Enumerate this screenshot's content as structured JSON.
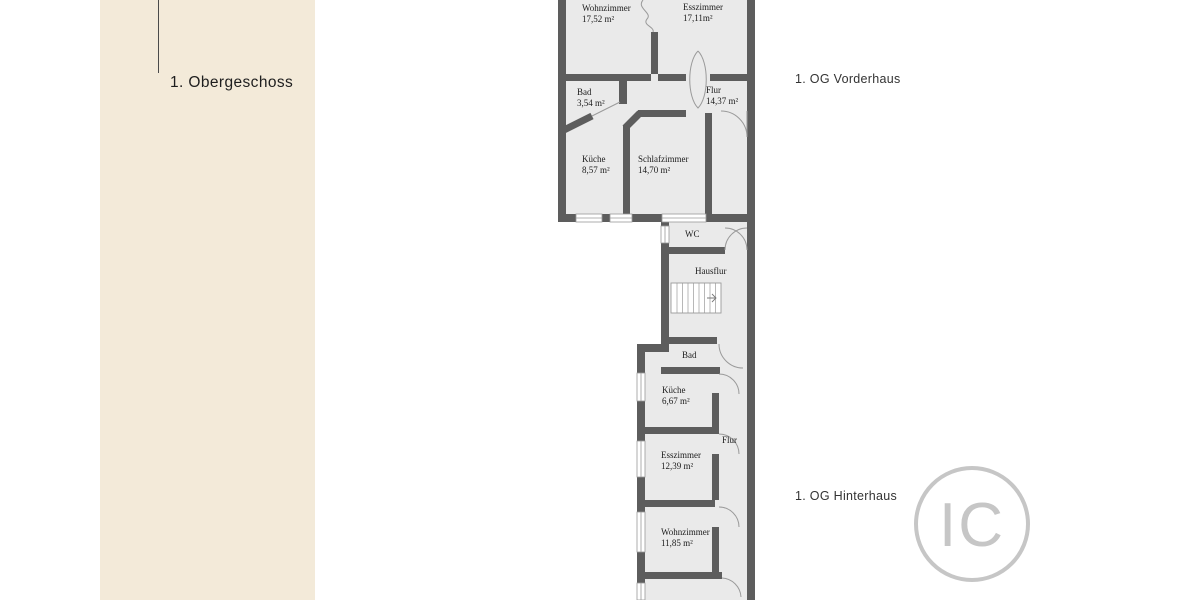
{
  "page": {
    "background": "#ffffff"
  },
  "sidebar": {
    "background_color": "#f3ead9",
    "title": "1. Obergeschoss"
  },
  "plan": {
    "wall_color": "#5d5d5d",
    "floor_color": "#eaeaea",
    "door_line_color": "#999999",
    "sections": [
      {
        "id": "vorderhaus",
        "label": "1. OG Vorderhaus"
      },
      {
        "id": "hinterhaus",
        "label": "1. OG Hinterhaus"
      }
    ],
    "rooms": [
      {
        "name": "Wohnzimmer",
        "area": "17,52 m²"
      },
      {
        "name": "Esszimmer",
        "area": "17,11m²"
      },
      {
        "name": "Bad",
        "area": "3,54 m²"
      },
      {
        "name": "Flur",
        "area": "14,37 m²"
      },
      {
        "name": "Küche",
        "area": "8,57 m²"
      },
      {
        "name": "Schlafzimmer",
        "area": "14,70 m²"
      },
      {
        "name": "WC",
        "area": ""
      },
      {
        "name": "Hausflur",
        "area": ""
      },
      {
        "name": "Bad",
        "area": ""
      },
      {
        "name": "Küche",
        "area": "6,67 m²"
      },
      {
        "name": "Flur",
        "area": ""
      },
      {
        "name": "Esszimmer",
        "area": "12,39 m²"
      },
      {
        "name": "Wohnzimmer",
        "area": "11,85 m²"
      }
    ]
  },
  "logo": {
    "text": "IC",
    "color": "#c6c6c6"
  }
}
